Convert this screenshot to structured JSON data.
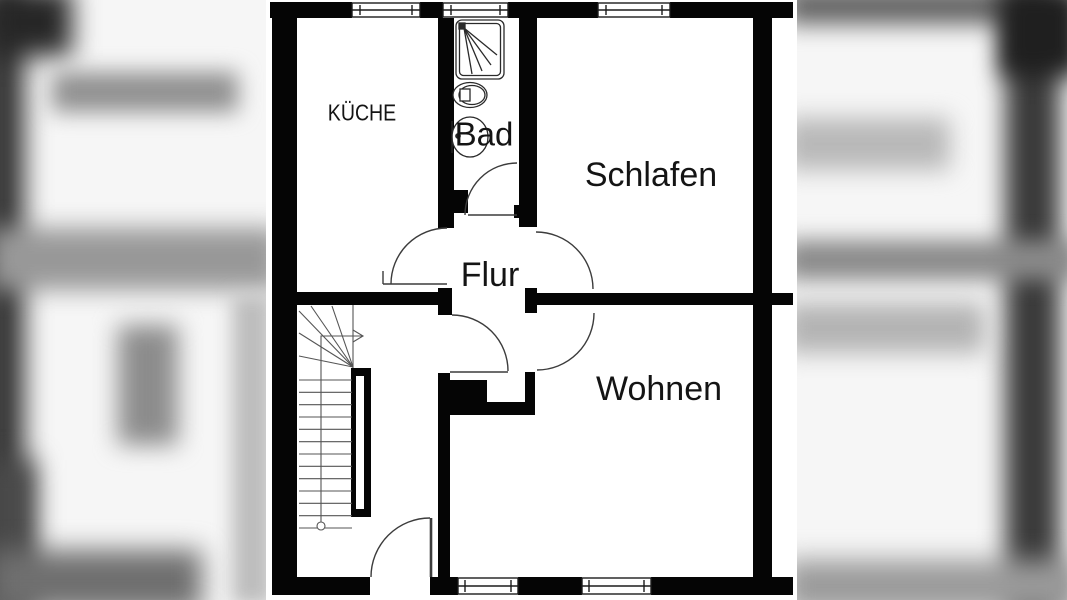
{
  "image": {
    "type": "apartment-floor-plan",
    "presentation": "letterboxed photo with blurred gray side panels"
  },
  "floorplan": {
    "rooms": {
      "kueche": "KÜCHE",
      "bad": "Bad",
      "schlafen": "Schlafen",
      "flur": "Flur",
      "wohnen": "Wohnen"
    },
    "fixtures": [
      "shower",
      "toilet",
      "sink",
      "staircase",
      "entry-door",
      "chimney"
    ],
    "window_count": 5,
    "colors": {
      "wall": "#050505",
      "door_line": "#3c3c3c",
      "stair_line": "#555555",
      "paper": "#ffffff",
      "text": "#141414"
    }
  }
}
